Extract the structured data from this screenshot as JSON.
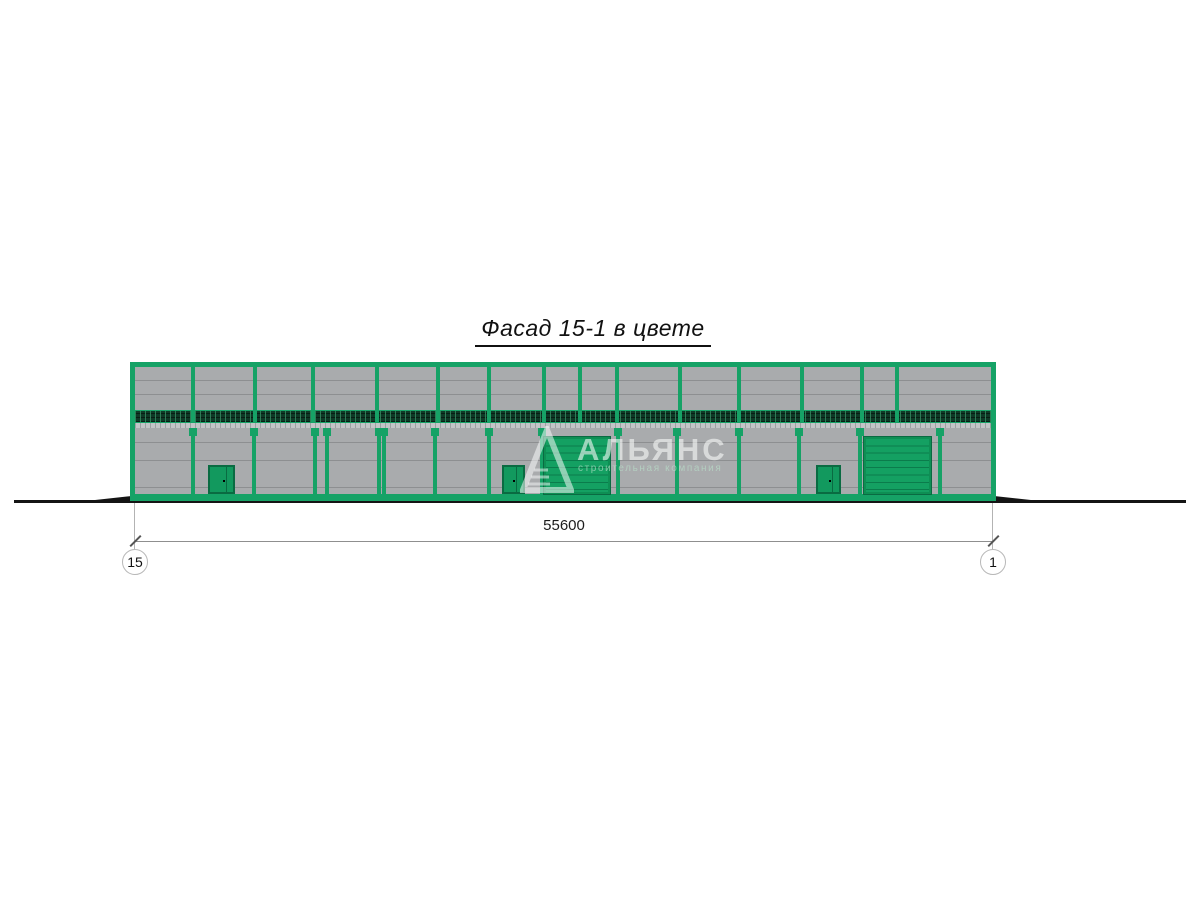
{
  "title": "Фасад 15-1 в цвете",
  "dimension": {
    "value": "55600",
    "left_grid_label": "15",
    "right_grid_label": "1"
  },
  "watermark": {
    "name": "АЛЬЯНС",
    "subtitle": "строительная компания"
  },
  "colors": {
    "frame_green": "#16a266",
    "door_green": "#12995e",
    "door_outline": "#0a6b42",
    "panel_gray": "#a9abad",
    "seam_gray": "#8d8f91",
    "louver_dark_green": "#0e3a27",
    "ground_black": "#141414"
  },
  "facade": {
    "building": {
      "left": 130,
      "top": 362,
      "width": 866,
      "height": 139
    },
    "upper_seams_y": [
      17.5,
      31.5
    ],
    "wall_seams_y": [
      80,
      98,
      125
    ],
    "upper_mullions_x": [
      61,
      123,
      181,
      245,
      306,
      357,
      412,
      448,
      485,
      548,
      607,
      670,
      730,
      765
    ],
    "lower_mullions_x": [
      61,
      122,
      183,
      195,
      247,
      252,
      303,
      357,
      410,
      486,
      545,
      607,
      667,
      728,
      808
    ],
    "doors": [
      {
        "x": 78,
        "width": 27
      },
      {
        "x": 372,
        "width": 23
      },
      {
        "x": 686,
        "width": 25
      }
    ],
    "gates": [
      {
        "x": 414,
        "width": 66
      },
      {
        "x": 734,
        "width": 67
      }
    ]
  }
}
